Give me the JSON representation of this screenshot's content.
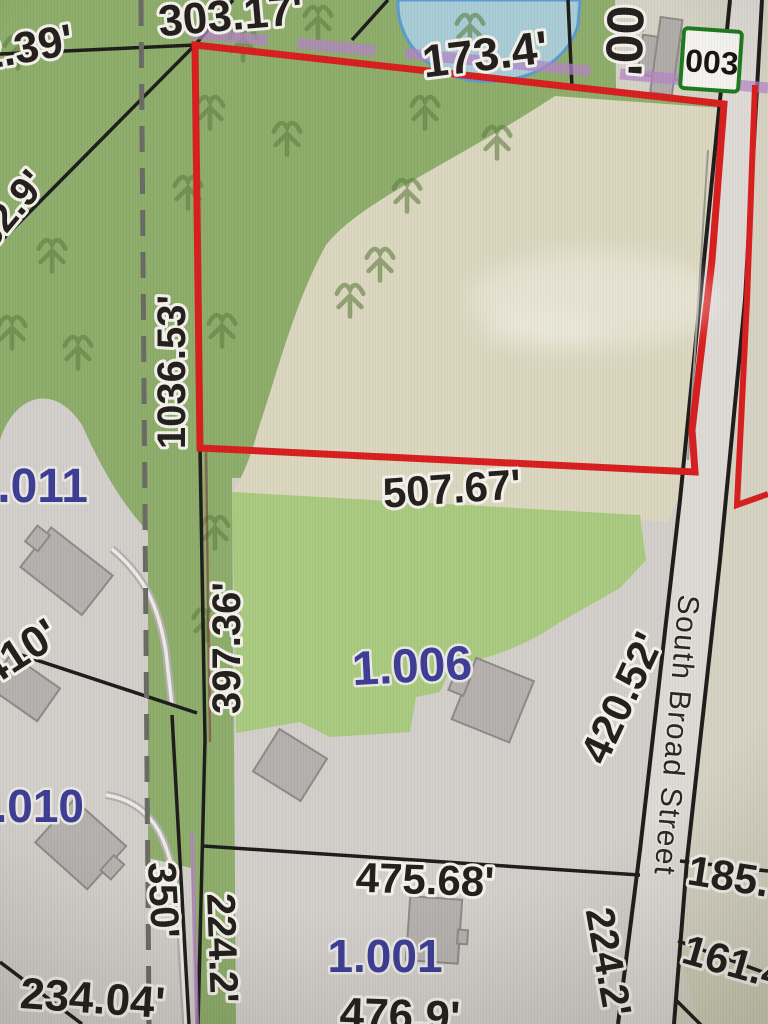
{
  "map_photo": {
    "street": {
      "name": "South Broad Street"
    },
    "selected_parcel_badge": "003",
    "parcel_ids": {
      "p1011": "1.011",
      "p1010": "1.010",
      "p1006": "1.006",
      "p1001": "1.001"
    },
    "dimensions": {
      "d303_17": "303.17'",
      "d2_39": "2.39'",
      "d173_4": "173.4'",
      "d00": "00'",
      "d62_9": "62.9'",
      "d1036_53": "1036.53'",
      "d507_67": "507.67'",
      "d397_36": "397.36'",
      "d420_52": "420.52'",
      "d410": "410'",
      "d350": "350'",
      "d234_04": "234.04'",
      "d224_2_w": "224.2'",
      "d475_68": "475.68'",
      "d476_9": "476.9'",
      "d224_2_e": "224.2'",
      "d185": "185.",
      "d161_4": "161.4"
    }
  },
  "colors": {
    "highlight_red": "#d81f1f",
    "parcel_blue": "#3d3d95",
    "badge_green": "#1e7a1e",
    "marker_purple": "#b483c6",
    "woods_green": "#8ead6b",
    "lawn_green": "#aaca80",
    "field_beige": "#dbd7bf",
    "parcel_gray": "#d3cfcb",
    "road_gray": "#dedad6",
    "pond_blue": "#a9ccd6",
    "pond_outline": "#5b9bd5"
  }
}
